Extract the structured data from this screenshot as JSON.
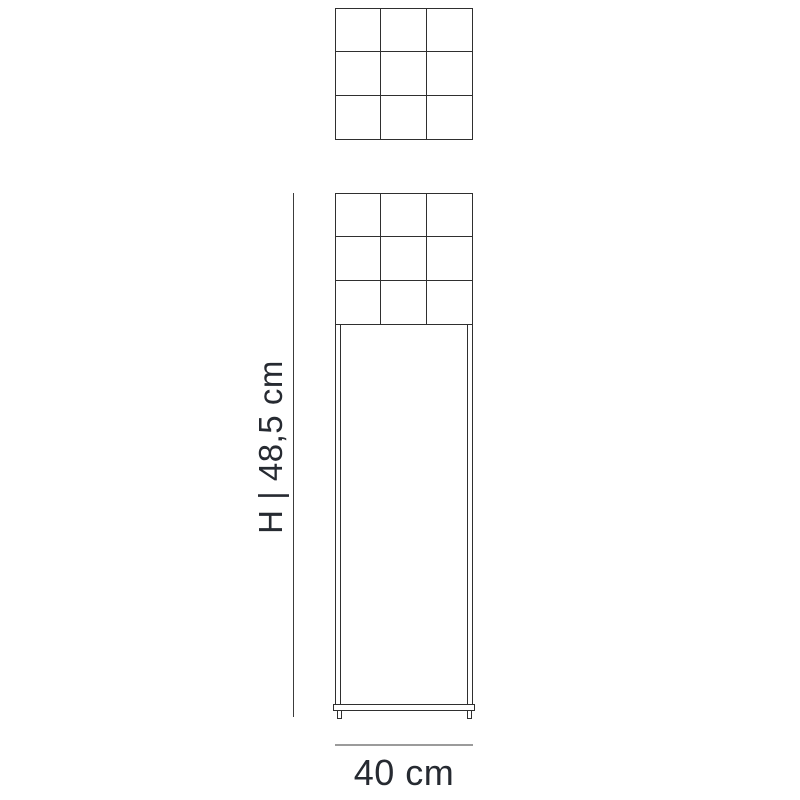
{
  "colors": {
    "background": "#ffffff",
    "line": "#2f2f2f",
    "dim_line": "#3c3c3c",
    "dim_line_gray": "#9b9b9b",
    "text": "#262a31"
  },
  "labels": {
    "height": "H | 48,5 cm",
    "width": "40 cm"
  },
  "views": {
    "top_view": {
      "rows": 3,
      "cols": 3
    },
    "front_view": {
      "rows": 3,
      "cols": 3
    }
  }
}
